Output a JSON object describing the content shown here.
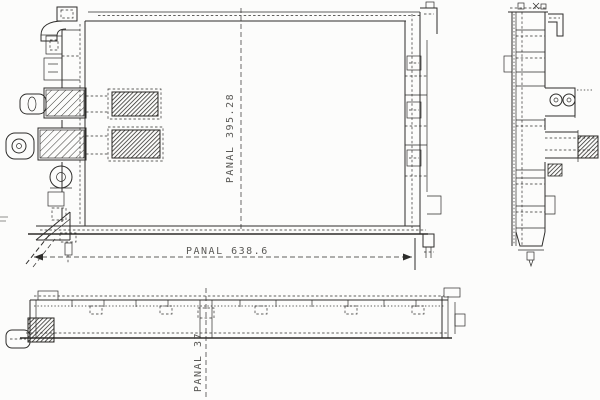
{
  "drawing": {
    "description_colors": {
      "background": "#fcfcfb",
      "line": "#2e2d2b",
      "text": "#4a4946"
    },
    "dimensions": {
      "width": {
        "label": "PANAL",
        "value": "638.6",
        "text": "PANAL  638.6"
      },
      "height": {
        "label": "PANAL",
        "value": "395.28",
        "text": "PANAL  395.28"
      },
      "depth": {
        "label": "PANAL",
        "value": "37",
        "text": "PANAL  37"
      }
    }
  }
}
